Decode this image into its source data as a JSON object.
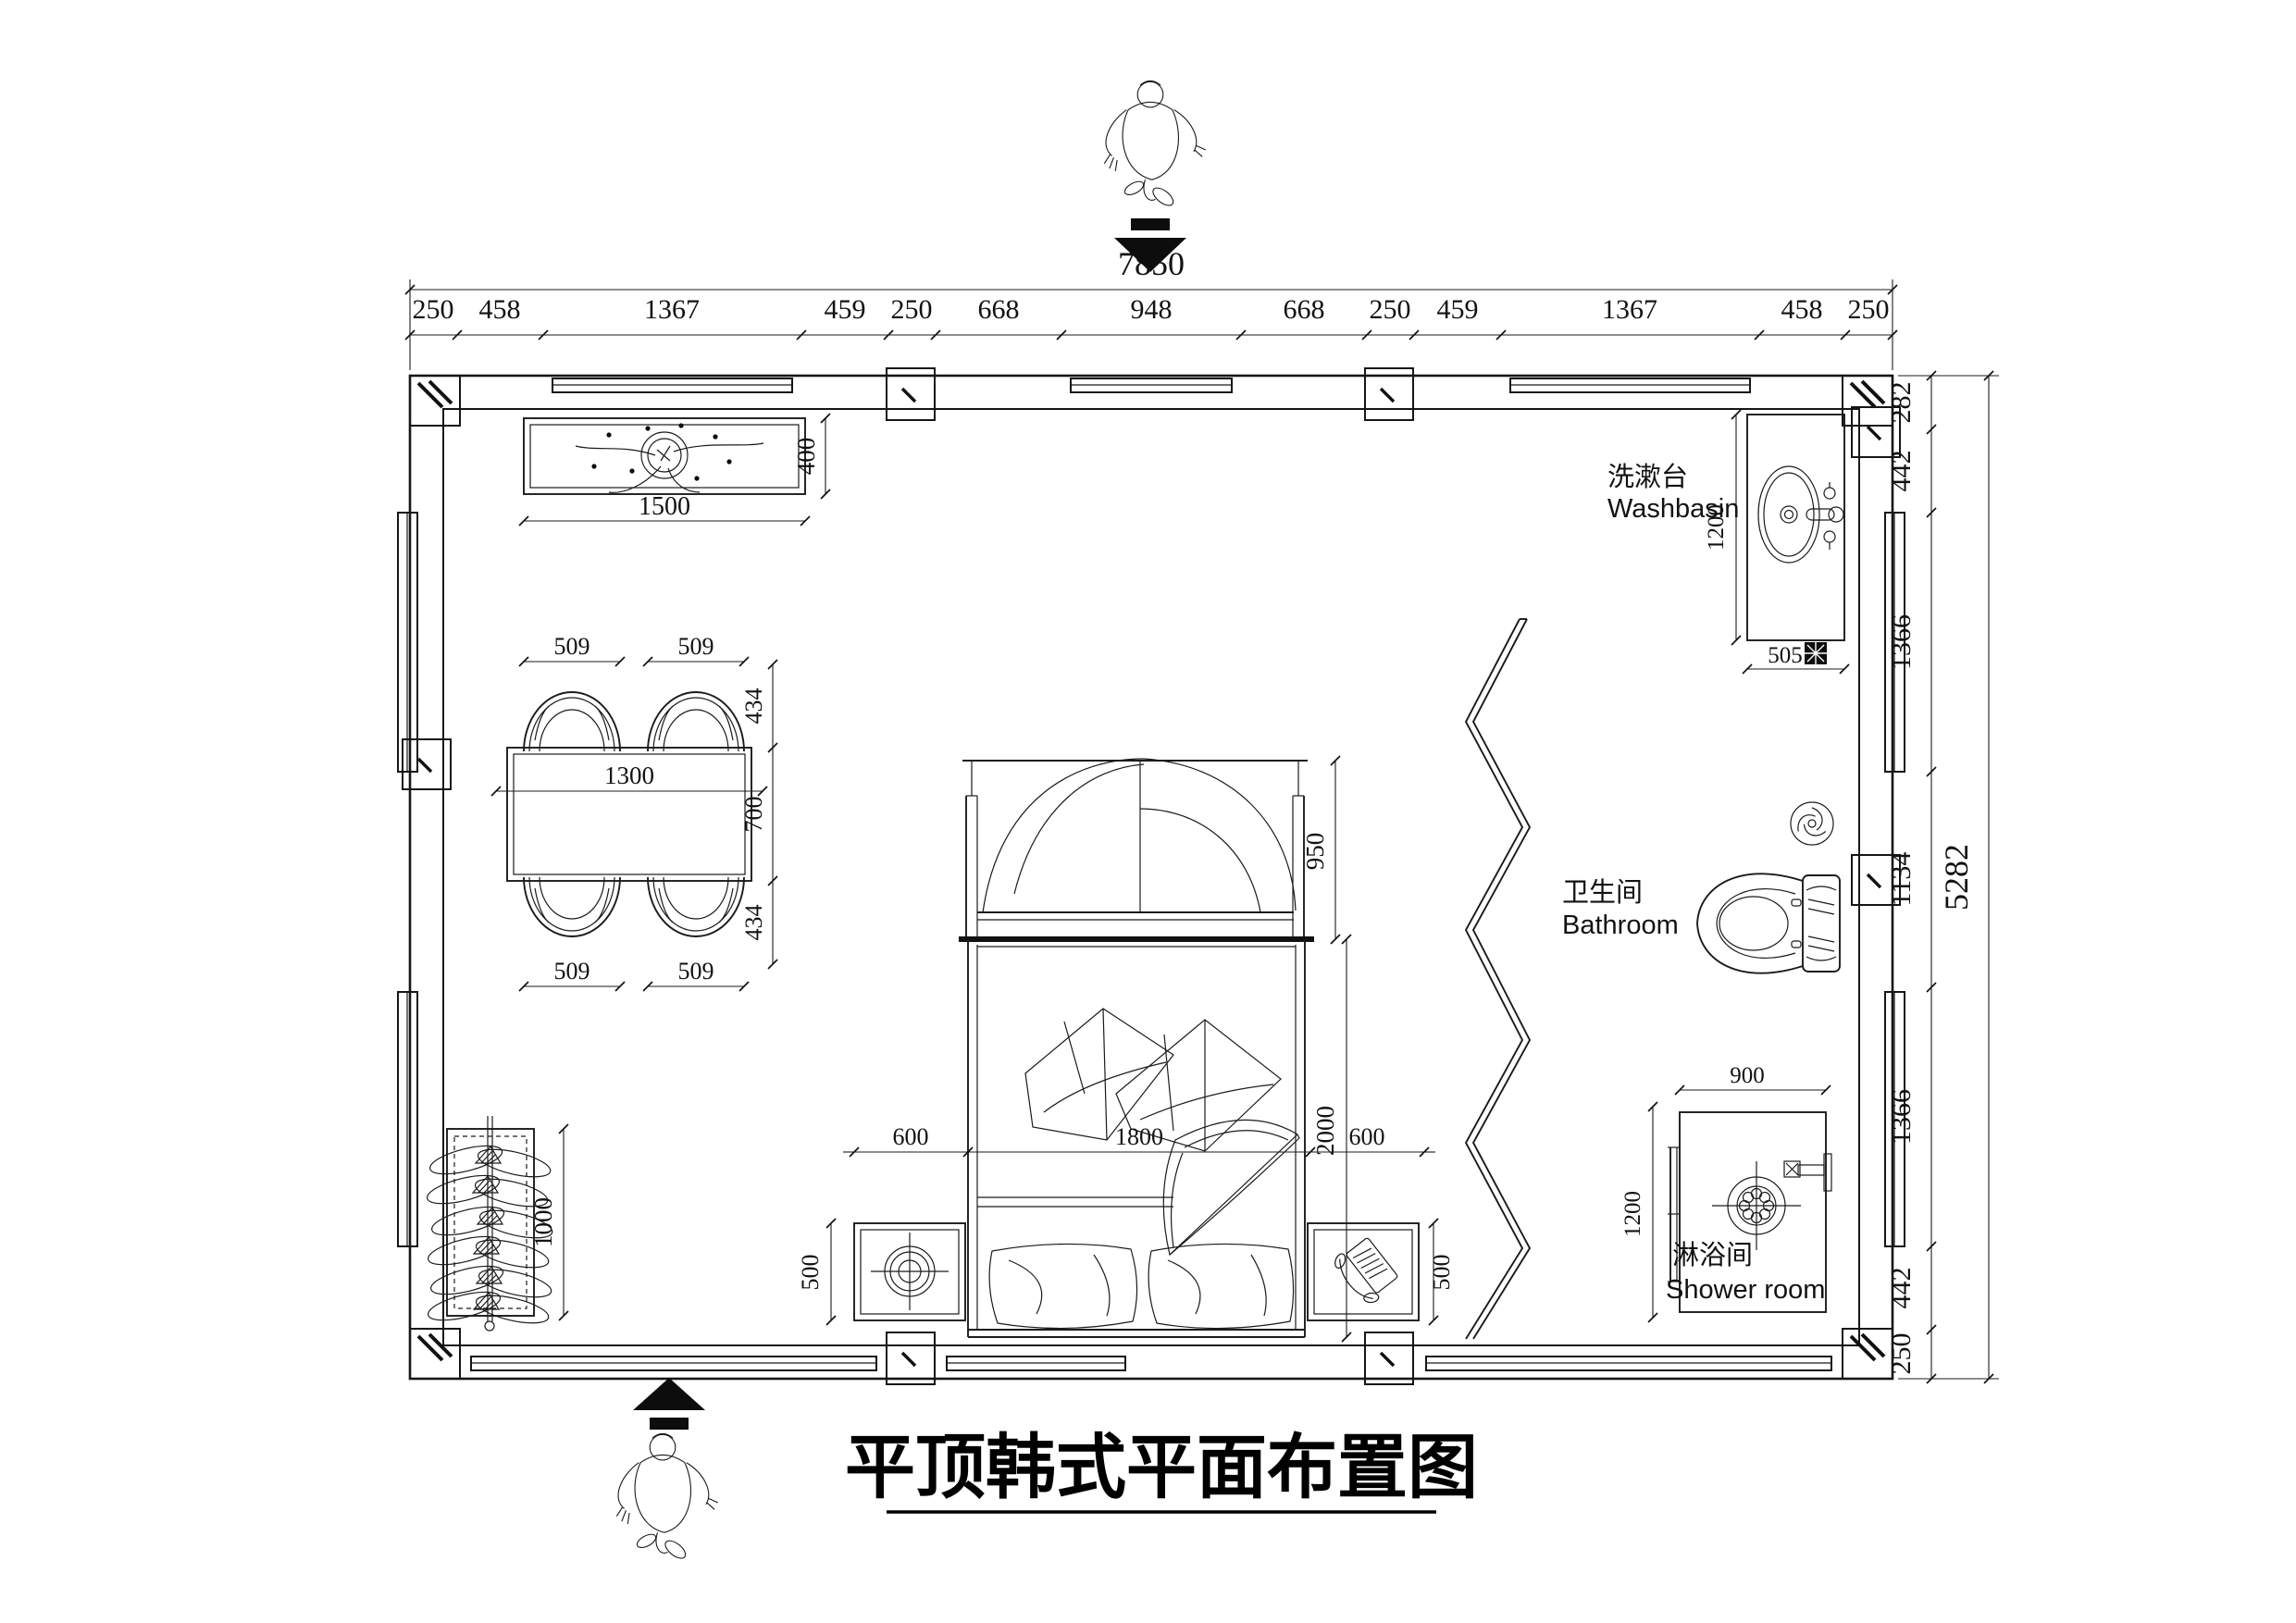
{
  "title": {
    "text": "平顶韩式平面布置图"
  },
  "dimensions": {
    "top_total": "7850",
    "top_chain": [
      "250",
      "458",
      "1367",
      "459",
      "250",
      "668",
      "948",
      "668",
      "250",
      "459",
      "1367",
      "458",
      "250"
    ],
    "right_total": "5282",
    "right_chain": [
      "282",
      "442",
      "1366",
      "1134",
      "1366",
      "442",
      "250"
    ]
  },
  "console": {
    "length": "1500",
    "depth": "400"
  },
  "dining": {
    "table_length": "1300",
    "table_depth": "700",
    "chair_width": "509",
    "chair_depth": "434"
  },
  "bed": {
    "bench_depth": "950",
    "length": "2000",
    "width": "1800",
    "side_clearance": "600",
    "nightstand_depth": "500"
  },
  "clothes_rack": {
    "length": "1000"
  },
  "washbasin": {
    "counter_length": "1200",
    "counter_depth": "505",
    "label_zh": "洗漱台",
    "label_en": "Washbasin"
  },
  "bathroom": {
    "label_zh": "卫生间",
    "label_en": "Bathroom"
  },
  "shower": {
    "width": "900",
    "depth": "1200",
    "label_zh": "淋浴间",
    "label_en": "Shower room"
  }
}
